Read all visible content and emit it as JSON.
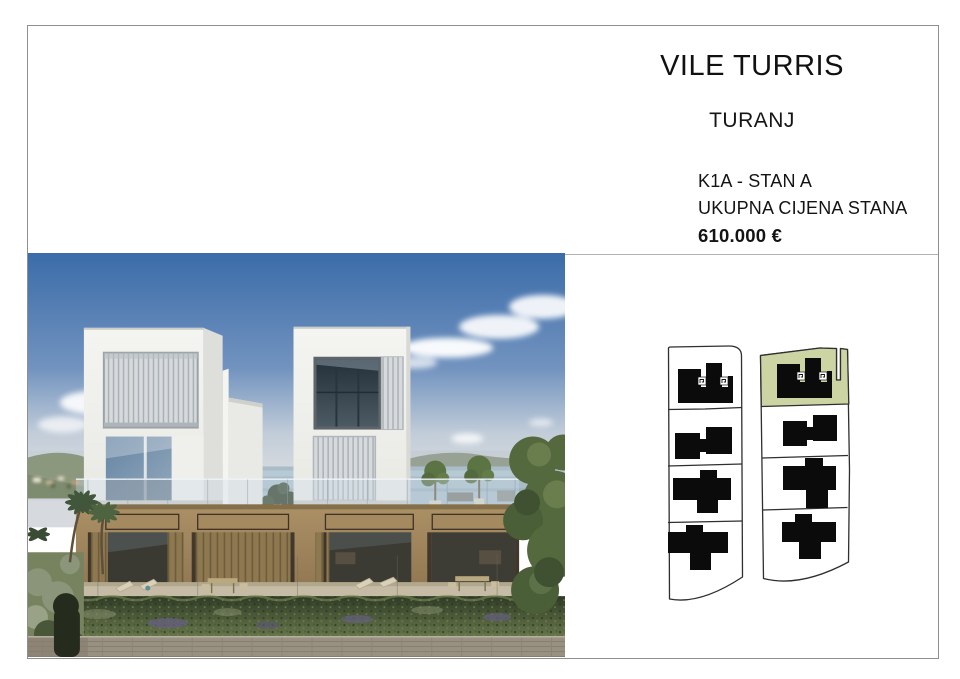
{
  "document": {
    "title": "VILE TURRIS",
    "location": "TURANJ",
    "unit": "K1A - STAN A",
    "price_label": "UKUPNA CIJENA STANA",
    "price_value": "610.000 €"
  },
  "site_plan": {
    "highlighted_unit": "K1A",
    "left_column_parcels": 4,
    "right_column_parcels": 4,
    "buildings_total": 8
  },
  "colors": {
    "highlight_parcel": "#cdd4a3",
    "building_footprint": "#0b0b0b",
    "parcel_outline": "#2f2f2f",
    "page_border": "#8f8f8f",
    "sky_top": "#3b6ca9",
    "facade_wood": "#a3895f",
    "hedge_green": "#4c5c39"
  }
}
